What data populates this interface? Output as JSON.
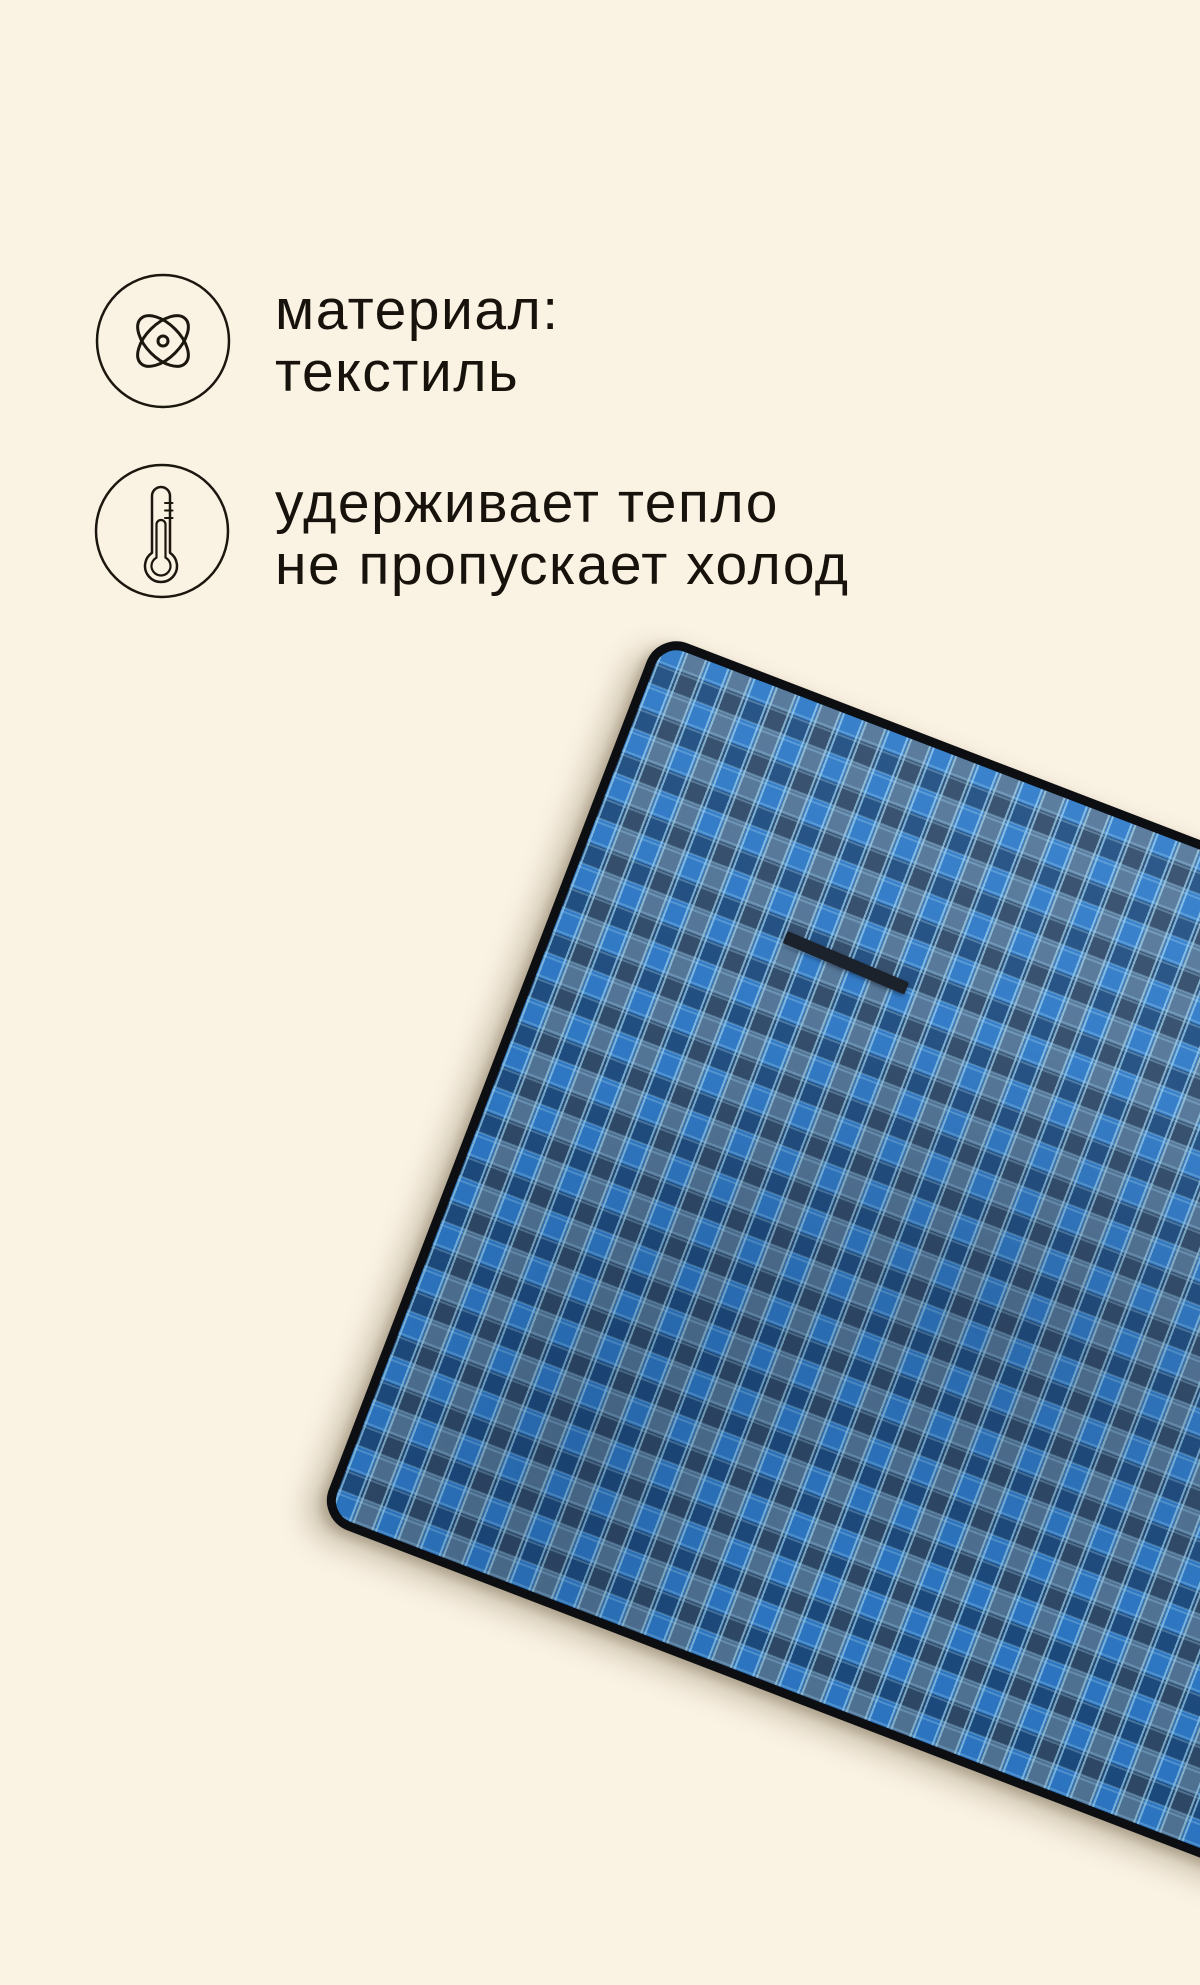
{
  "card": {
    "features": [
      {
        "id": "material",
        "icon": "atom-icon",
        "lines": [
          "материал:",
          "текстиль"
        ]
      },
      {
        "id": "insulation",
        "icon": "thermometer-icon",
        "lines": [
          "удерживает тепло",
          "не пропускает холод"
        ]
      }
    ],
    "photo": {
      "subject": "picnic-blanket",
      "pattern": "blue-plaid",
      "detail": "carry-handle-strap"
    }
  },
  "theme": {
    "bg": "#faf2e3",
    "text": "#17130c",
    "stroke": "#1b160e",
    "plaid-bright": "#2f7dce",
    "plaid-slate": "#54789c",
    "plaid-dark": "rgba(15,36,66,0.52)",
    "plaid-stitch": "#9ed6f5",
    "edge": "#0d0e12",
    "strap": "#1c222c"
  }
}
